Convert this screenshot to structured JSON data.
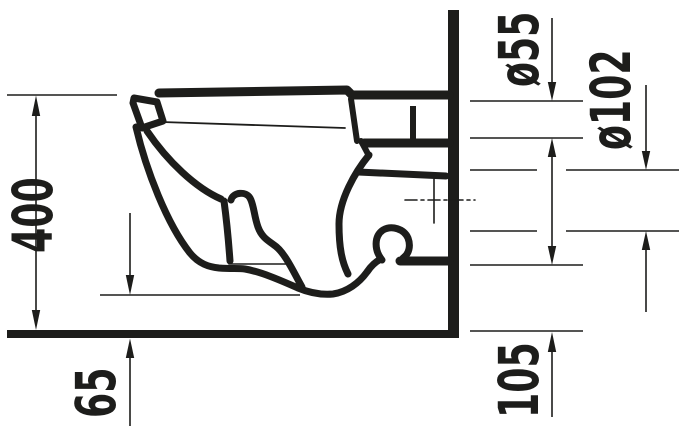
{
  "figure": {
    "ink_color": "#1d1d1b",
    "background_color": "#ffffff",
    "labels": {
      "overall_height": "400",
      "floor_gap": "65",
      "outlet_bottom_height": "105",
      "flush_pipe_diameter": "ø55",
      "outlet_pipe_diameter": "ø102"
    }
  }
}
